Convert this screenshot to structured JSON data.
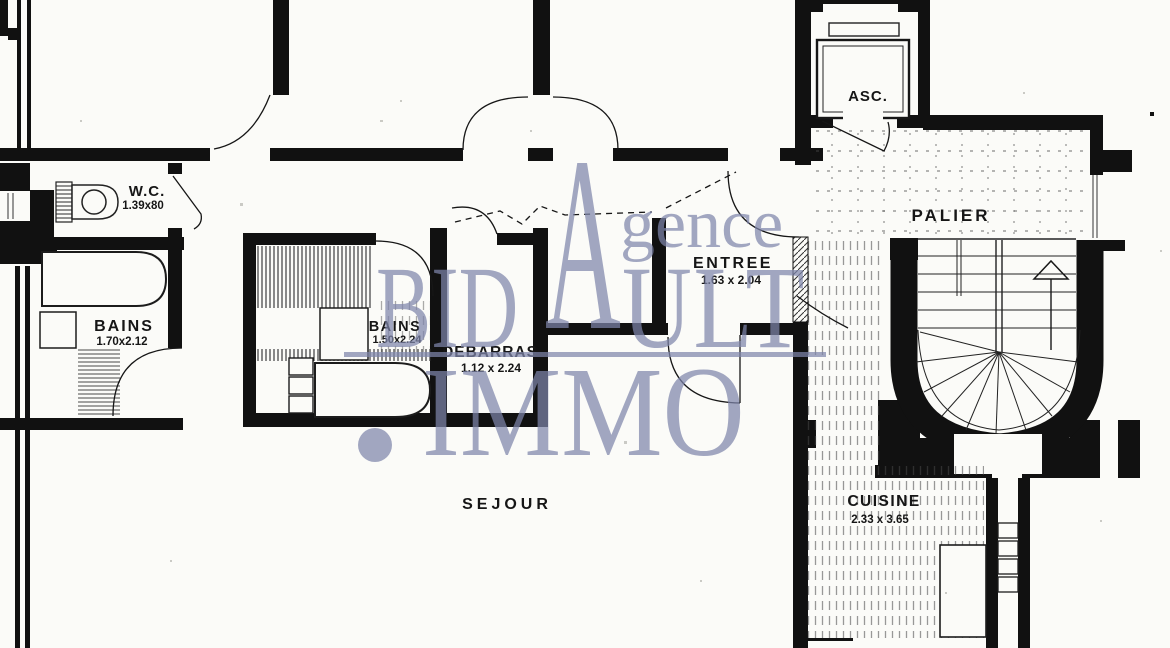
{
  "document": {
    "type": "apartment floor plan (scanned)",
    "floor_texture_zones": [
      "palier tiled grid",
      "cuisine hatched floor",
      "bains tiled walls"
    ]
  },
  "rooms": [
    {
      "id": "wc",
      "name": "W.C.",
      "dims": "1.39x80"
    },
    {
      "id": "bains1",
      "name": "BAINS",
      "dims": "1.70x2.12"
    },
    {
      "id": "bains2",
      "name": "BAINS",
      "dims": "1.50x2.24"
    },
    {
      "id": "debarras",
      "name": "DEBARRAS",
      "dims": "1.12 x 2.24"
    },
    {
      "id": "entree",
      "name": "ENTREE",
      "dims": "1.63 x 2.04"
    },
    {
      "id": "sejour",
      "name": "SEJOUR",
      "dims": ""
    },
    {
      "id": "cuisine",
      "name": "CUISINE",
      "dims": "2.33 x 3.65"
    },
    {
      "id": "palier",
      "name": "PALIER",
      "dims": ""
    },
    {
      "id": "asc",
      "name": "ASC.",
      "dims": ""
    }
  ],
  "stairs": {
    "type": "winder staircase",
    "direction": "up-arrow"
  },
  "fixtures": [
    "toilet",
    "bathtub",
    "bathtub",
    "washbasin",
    "shower-tray",
    "elevator-cab",
    "kitchen-counter",
    "duct-shaft"
  ],
  "watermark": {
    "big_letter": "A",
    "word1_rest": "gence",
    "word2_left": "BID",
    "word2_right": "ULT",
    "dot": "",
    "word3": "IMMO",
    "color": "#9ba1c4"
  },
  "colors": {
    "ink": "#111111",
    "paper": "#fbfbf8",
    "watermark": "#9ba1c4"
  }
}
